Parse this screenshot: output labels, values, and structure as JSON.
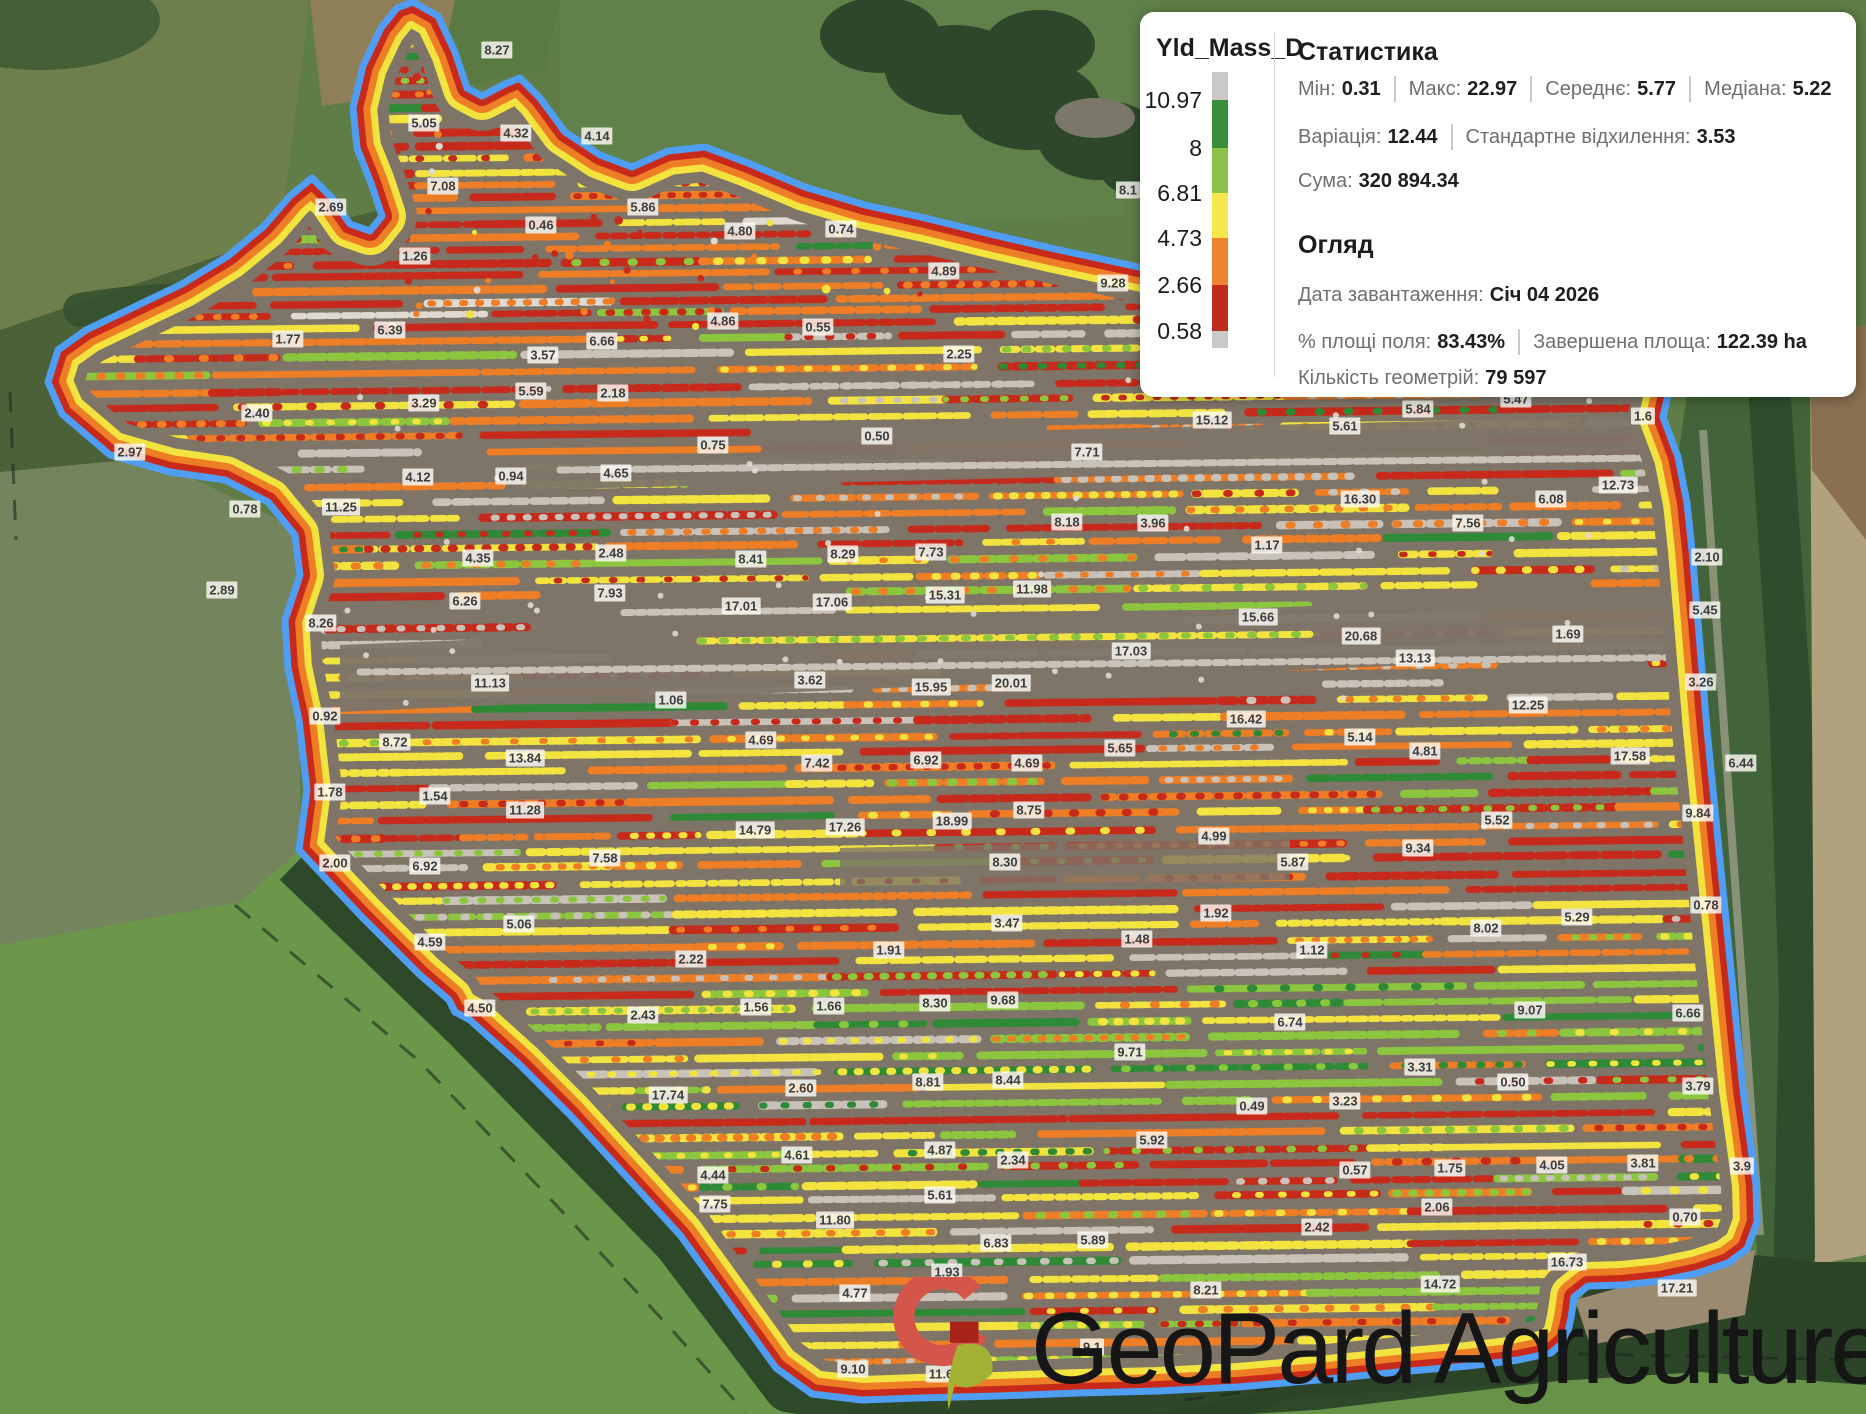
{
  "map": {
    "watermark": "GeoPard Agriculture",
    "palette": {
      "red": "#c7291a",
      "orange": "#ee7e26",
      "yellow": "#f2e33e",
      "light_green": "#8cc63f",
      "green": "#2f8a38",
      "gray": "#c8c2b8",
      "white": "#dedad2",
      "soil": "#7e7468",
      "boundary_blue": "#4f9ef4"
    },
    "labels": [
      [
        497,
        50,
        "8.27"
      ],
      [
        424,
        123,
        "5.05"
      ],
      [
        516,
        133,
        "4.32"
      ],
      [
        597,
        136,
        "4.14"
      ],
      [
        331,
        207,
        "2.69"
      ],
      [
        443,
        186,
        "7.08"
      ],
      [
        643,
        207,
        "5.86"
      ],
      [
        541,
        225,
        "0.46"
      ],
      [
        740,
        231,
        "4.80"
      ],
      [
        841,
        229,
        "0.74"
      ],
      [
        415,
        256,
        "1.26"
      ],
      [
        944,
        271,
        "4.89"
      ],
      [
        1113,
        283,
        "9.28"
      ],
      [
        1128,
        190,
        "8.1"
      ],
      [
        288,
        339,
        "1.77"
      ],
      [
        390,
        330,
        "6.39"
      ],
      [
        723,
        321,
        "4.86"
      ],
      [
        818,
        327,
        "0.55"
      ],
      [
        602,
        341,
        "6.66"
      ],
      [
        543,
        355,
        "3.57"
      ],
      [
        959,
        354,
        "2.25"
      ],
      [
        531,
        391,
        "5.59"
      ],
      [
        613,
        393,
        "2.18"
      ],
      [
        424,
        403,
        "3.29"
      ],
      [
        257,
        413,
        "2.40"
      ],
      [
        1212,
        420,
        "15.12"
      ],
      [
        1345,
        426,
        "5.61"
      ],
      [
        1418,
        409,
        "5.84"
      ],
      [
        1516,
        399,
        "5.47"
      ],
      [
        1643,
        416,
        "1.6"
      ],
      [
        130,
        452,
        "2.97"
      ],
      [
        713,
        445,
        "0.75"
      ],
      [
        877,
        436,
        "0.50"
      ],
      [
        1087,
        452,
        "7.71"
      ],
      [
        418,
        477,
        "4.12"
      ],
      [
        511,
        476,
        "0.94"
      ],
      [
        616,
        473,
        "4.65"
      ],
      [
        1551,
        499,
        "6.08"
      ],
      [
        1618,
        485,
        "12.73"
      ],
      [
        245,
        509,
        "0.78"
      ],
      [
        341,
        507,
        "11.25"
      ],
      [
        1360,
        499,
        "16.30"
      ],
      [
        1067,
        522,
        "8.18"
      ],
      [
        1153,
        523,
        "3.96"
      ],
      [
        1468,
        523,
        "7.56"
      ],
      [
        1707,
        557,
        "2.10"
      ],
      [
        478,
        558,
        "4.35"
      ],
      [
        611,
        553,
        "2.48"
      ],
      [
        751,
        559,
        "8.41"
      ],
      [
        843,
        554,
        "8.29"
      ],
      [
        931,
        552,
        "7.73"
      ],
      [
        1267,
        545,
        "1.17"
      ],
      [
        1705,
        610,
        "5.45"
      ],
      [
        222,
        590,
        "2.89"
      ],
      [
        465,
        601,
        "6.26"
      ],
      [
        610,
        593,
        "7.93"
      ],
      [
        741,
        606,
        "17.01"
      ],
      [
        832,
        602,
        "17.06"
      ],
      [
        945,
        595,
        "15.31"
      ],
      [
        1032,
        589,
        "11.98"
      ],
      [
        1258,
        617,
        "15.66"
      ],
      [
        321,
        623,
        "8.26"
      ],
      [
        1361,
        636,
        "20.68"
      ],
      [
        1568,
        634,
        "1.69"
      ],
      [
        1131,
        651,
        "17.03"
      ],
      [
        1415,
        658,
        "13.13"
      ],
      [
        1701,
        682,
        "3.26"
      ],
      [
        490,
        683,
        "11.13"
      ],
      [
        810,
        680,
        "3.62"
      ],
      [
        931,
        687,
        "15.95"
      ],
      [
        1011,
        683,
        "20.01"
      ],
      [
        671,
        700,
        "1.06"
      ],
      [
        325,
        716,
        "0.92"
      ],
      [
        1246,
        719,
        "16.42"
      ],
      [
        1528,
        705,
        "12.25"
      ],
      [
        395,
        742,
        "8.72"
      ],
      [
        761,
        740,
        "4.69"
      ],
      [
        525,
        758,
        "13.84"
      ],
      [
        817,
        763,
        "7.42"
      ],
      [
        926,
        760,
        "6.92"
      ],
      [
        1027,
        763,
        "4.69"
      ],
      [
        1120,
        748,
        "5.65"
      ],
      [
        1360,
        737,
        "5.14"
      ],
      [
        1425,
        751,
        "4.81"
      ],
      [
        1630,
        756,
        "17.58"
      ],
      [
        1741,
        763,
        "6.44"
      ],
      [
        330,
        792,
        "1.78"
      ],
      [
        435,
        796,
        "1.54"
      ],
      [
        525,
        810,
        "11.28"
      ],
      [
        755,
        830,
        "14.79"
      ],
      [
        845,
        827,
        "17.26"
      ],
      [
        952,
        821,
        "18.99"
      ],
      [
        1029,
        810,
        "8.75"
      ],
      [
        1698,
        813,
        "9.84"
      ],
      [
        1214,
        836,
        "4.99"
      ],
      [
        1497,
        820,
        "5.52"
      ],
      [
        335,
        863,
        "2.00"
      ],
      [
        425,
        866,
        "6.92"
      ],
      [
        605,
        858,
        "7.58"
      ],
      [
        1005,
        862,
        "8.30"
      ],
      [
        1293,
        862,
        "5.87"
      ],
      [
        1418,
        848,
        "9.34"
      ],
      [
        519,
        924,
        "5.06"
      ],
      [
        430,
        942,
        "4.59"
      ],
      [
        1007,
        923,
        "3.47"
      ],
      [
        1216,
        913,
        "1.92"
      ],
      [
        1137,
        939,
        "1.48"
      ],
      [
        1486,
        928,
        "8.02"
      ],
      [
        1577,
        917,
        "5.29"
      ],
      [
        1706,
        905,
        "0.78"
      ],
      [
        691,
        959,
        "2.22"
      ],
      [
        889,
        950,
        "1.91"
      ],
      [
        1312,
        950,
        "1.12"
      ],
      [
        480,
        1008,
        "4.50"
      ],
      [
        643,
        1015,
        "2.43"
      ],
      [
        756,
        1007,
        "1.56"
      ],
      [
        829,
        1006,
        "1.66"
      ],
      [
        935,
        1003,
        "8.30"
      ],
      [
        1003,
        1000,
        "9.68"
      ],
      [
        1290,
        1022,
        "6.74"
      ],
      [
        1530,
        1010,
        "9.07"
      ],
      [
        1688,
        1013,
        "6.66"
      ],
      [
        1130,
        1052,
        "9.71"
      ],
      [
        1420,
        1067,
        "3.31"
      ],
      [
        668,
        1095,
        "17.74"
      ],
      [
        801,
        1088,
        "2.60"
      ],
      [
        928,
        1082,
        "8.81"
      ],
      [
        1008,
        1080,
        "8.44"
      ],
      [
        1513,
        1082,
        "0.50"
      ],
      [
        1698,
        1086,
        "3.79"
      ],
      [
        1252,
        1106,
        "0.49"
      ],
      [
        1345,
        1101,
        "3.23"
      ],
      [
        713,
        1175,
        "4.44"
      ],
      [
        797,
        1155,
        "4.61"
      ],
      [
        940,
        1150,
        "4.87"
      ],
      [
        1013,
        1160,
        "2.34"
      ],
      [
        1152,
        1140,
        "5.92"
      ],
      [
        1355,
        1170,
        "0.57"
      ],
      [
        1450,
        1168,
        "1.75"
      ],
      [
        1552,
        1165,
        "4.05"
      ],
      [
        1643,
        1163,
        "3.81"
      ],
      [
        1742,
        1166,
        "3.9"
      ],
      [
        1437,
        1207,
        "2.06"
      ],
      [
        1685,
        1217,
        "0.70"
      ],
      [
        715,
        1204,
        "7.75"
      ],
      [
        940,
        1195,
        "5.61"
      ],
      [
        835,
        1220,
        "11.80"
      ],
      [
        996,
        1243,
        "6.83"
      ],
      [
        1093,
        1240,
        "5.89"
      ],
      [
        1317,
        1227,
        "2.42"
      ],
      [
        1567,
        1262,
        "16.73"
      ],
      [
        947,
        1272,
        "1.93"
      ],
      [
        855,
        1293,
        "4.77"
      ],
      [
        1206,
        1290,
        "8.21"
      ],
      [
        1440,
        1284,
        "14.72"
      ],
      [
        1677,
        1288,
        "17.21"
      ],
      [
        853,
        1369,
        "9.10"
      ],
      [
        941,
        1374,
        "11.6"
      ],
      [
        1092,
        1347,
        "9.1"
      ]
    ]
  },
  "panel": {
    "legend": {
      "title": "Yld_Mass_D",
      "values": [
        "10.97",
        "8",
        "6.81",
        "4.73",
        "2.66",
        "0.58"
      ],
      "colors": [
        "#c9c9c9",
        "#388e3c",
        "#8bc34a",
        "#f6e84a",
        "#ee8432",
        "#bf2b1d",
        "#c9c9c9"
      ]
    },
    "stats": {
      "title": "Статистика",
      "line1": [
        {
          "l": "Мін:",
          "v": "0.31"
        },
        {
          "l": "Макс:",
          "v": "22.97"
        },
        {
          "l": "Середнє:",
          "v": "5.77"
        },
        {
          "l": "Медіана:",
          "v": "5.22"
        }
      ],
      "line2": [
        {
          "l": "Варіація:",
          "v": "12.44"
        },
        {
          "l": "Стандартне відхилення:",
          "v": "3.53"
        }
      ],
      "line3": [
        {
          "l": "Сума:",
          "v": "320 894.34"
        }
      ]
    },
    "overview": {
      "title": "Огляд",
      "line1": [
        {
          "l": "Дата завантаження:",
          "v": "Січ 04 2026"
        }
      ],
      "line2": [
        {
          "l": "% площі поля:",
          "v": "83.43%"
        },
        {
          "l": "Завершена площа:",
          "v": "122.39 ha"
        }
      ],
      "line3": [
        {
          "l": "Кількість геометрій:",
          "v": "79 597"
        }
      ]
    }
  }
}
